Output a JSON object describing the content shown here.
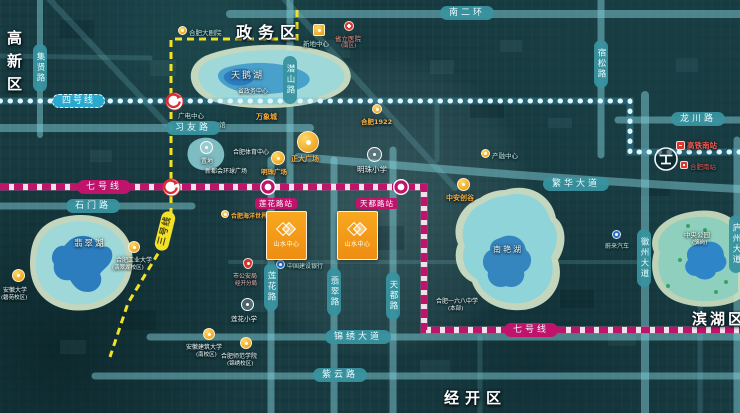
{
  "colors": {
    "background": "#173b41",
    "road": "#7ecbd6",
    "road_pill": "#38929f",
    "metro_line4_blue": "#2aa9cf",
    "metro_line7_magenta": "#c0136b",
    "metro_line3_yellow": "#f2e126",
    "project_orange": "#f59f1e",
    "poi_orange": "#ffae3d",
    "lake_blue": "#2b7dbd",
    "lake_teal": "#9fd8d8",
    "lake_shore": "#d3e4c9"
  },
  "districts": {
    "gaoxinqu": "高新区",
    "zhengwuqu": "政务区",
    "binhuqu": "滨湖区",
    "jingkaiqu": "经开区"
  },
  "roads": {
    "jixianlu": "集贤路",
    "xiyoulu": "习友路",
    "qianshanlu": "潜山路",
    "nanerhuan": "南二环",
    "susonglu": "宿松路",
    "longchuanlu": "龙川路",
    "fanhuadadao": "繁华大道",
    "shimenlu": "石门路",
    "lianhualu": "莲花路",
    "feicuilu": "翡翠路",
    "tiandulu": "天都路",
    "jinxiudadao": "锦绣大道",
    "ziyunlu": "紫云路",
    "huizhoudadao": "徽州大道",
    "luzhoudadao": "庐州大道"
  },
  "metro": {
    "line4_label": "四号线",
    "line7_label_left": "七号线",
    "line7_label_right": "七号线",
    "line3_label": "三号线",
    "station_lianhua": "莲花路站",
    "station_tiandu": "天都路站"
  },
  "lakes": {
    "tianehu": "天鹅湖",
    "feicuihu": "翡翠湖",
    "nanyanhu": "南艳湖"
  },
  "project": {
    "name": "山水中心"
  },
  "pois": {
    "dajuyuan": "合肥大剧院",
    "xindizhongxin": "新地中心",
    "shengliyiyuan": "省立医院",
    "shengliyiyuan_sub": "(南区)",
    "zhengwu_center": "省政务中心",
    "guangdian": "广电中心",
    "bowuguan": "安徽博物馆",
    "zhidi": "置地",
    "tiyu": "合肥体育中心",
    "xinduhui": "新都会环球广场",
    "wanxiangcheng": "万象城",
    "hefei1922": "合肥1922",
    "zhengda": "正大广场",
    "mingzhuguangchang": "明珠广场",
    "mingzhuxiaoxue": "明珠小学",
    "haiyang": "合肥海洋世界",
    "chanrong": "产融中心",
    "zhonganchuanggu": "中安创谷",
    "yiliuba": "合肥一六八中学",
    "yiliuba_sub": "(本部)",
    "weilai": "蔚来汽车",
    "zhongyanggongyuan": "中央公园",
    "zhongyanggongyuan_sub": "(骆岗)",
    "gaotienanzhan": "高铁南站",
    "hefeinanzhan": "合肥南站",
    "gongda": "合肥工业大学",
    "gongda_sub": "(翡翠湖校区)",
    "anda": "安徽大学",
    "anda_sub": "(磬苑校区)",
    "gonganju": "市公安局",
    "gonganju_sub": "经开分局",
    "jianhang": "中国建设银行",
    "lianhuaxiaoxue": "莲花小学",
    "anjianda": "安徽建筑大学",
    "anjianda_sub": "(南校区)",
    "shifan": "合肥师范学院",
    "shifan_sub": "(锦绣校区)"
  }
}
